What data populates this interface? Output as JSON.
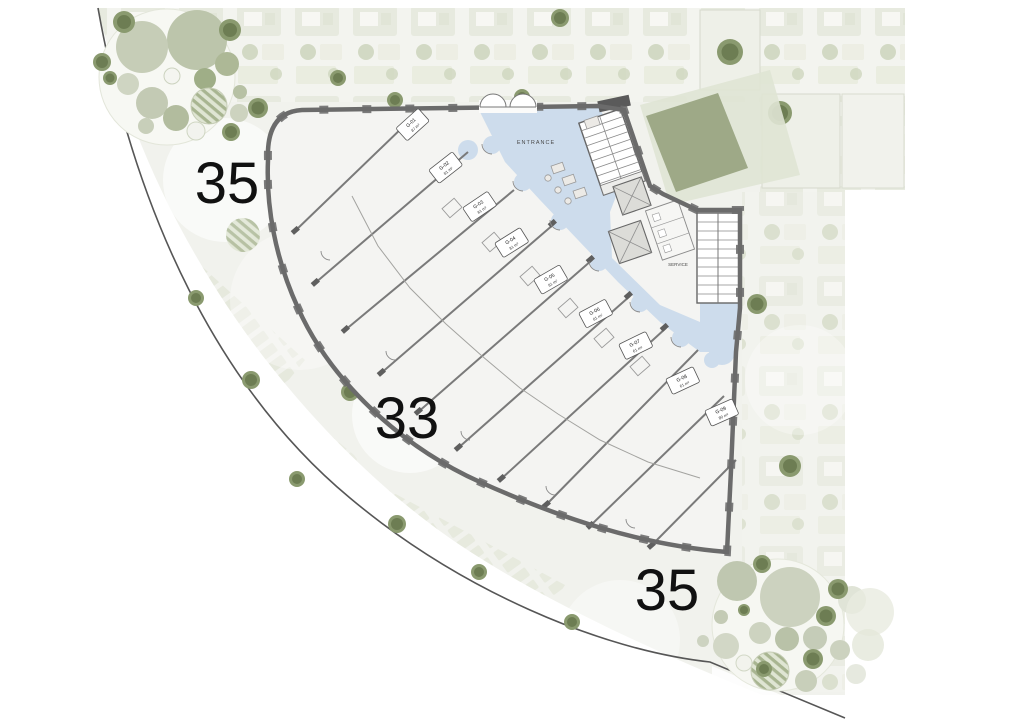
{
  "page": {
    "title": "Ground floor site plan"
  },
  "plot_numbers": [
    {
      "value": "35"
    },
    {
      "value": "33"
    },
    {
      "value": "35"
    }
  ],
  "labels": {
    "entrance": "ENTRANCE",
    "service": "SERVICE"
  },
  "units": [
    {
      "id": "G-01",
      "area": "87 m²"
    },
    {
      "id": "G-02",
      "area": "81 m²"
    },
    {
      "id": "G-03",
      "area": "81 m²"
    },
    {
      "id": "G-04",
      "area": "81 m²"
    },
    {
      "id": "G-05",
      "area": "81 m²"
    },
    {
      "id": "G-06",
      "area": "81 m²"
    },
    {
      "id": "G-07",
      "area": "61 m²"
    },
    {
      "id": "G-08",
      "area": "61 m²"
    },
    {
      "id": "G-09",
      "area": "80 m²"
    }
  ],
  "colors": {
    "wall": "#6b6b6b",
    "floor": "#f4f4f2",
    "corridor": "#cddcec",
    "land": "#f1f2ed",
    "tree": "#8a9a6f",
    "tree-dark": "#6d7d53",
    "roofgarden": "#9aa583",
    "text": "#111111"
  }
}
